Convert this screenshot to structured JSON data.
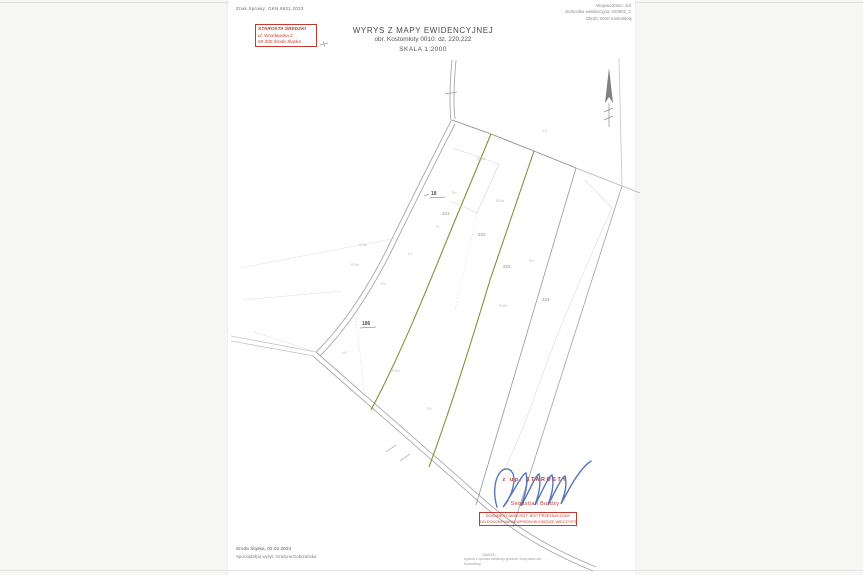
{
  "document": {
    "case_number": "Znak Sprawy: GKN.6621.2023",
    "region_lines": {
      "line1": "Województwo: dol.",
      "line2": "Jednostka ewidencyjna: 020902_2.",
      "line3": "Obręb: 0010 Kostomłoty"
    },
    "stamp": {
      "line1": "STAROSTA ŚREDZKI",
      "line2": "ul. Wrocławska 2",
      "line3": "55-300 Środa Śląska"
    },
    "title": {
      "line1": "WYRYS Z MAPY EWIDENCYJNEJ",
      "line2": "obr. Kostomłoty 0010: dz. 220,222",
      "line3": "SKALA 1:2000"
    }
  },
  "map": {
    "subject_parcels": "220,222",
    "scale": "1:2000",
    "parcel_labels": [
      {
        "text": "18"
      },
      {
        "text": "221"
      },
      {
        "text": "222"
      },
      {
        "text": "223"
      },
      {
        "text": "224"
      },
      {
        "text": "186"
      }
    ],
    "terrain_labels": [
      {
        "text": "RIVa"
      },
      {
        "text": "RV"
      },
      {
        "text": "RIVb"
      },
      {
        "text": "ŁV"
      },
      {
        "text": "RIVa"
      },
      {
        "text": "RIVb"
      },
      {
        "text": "RV"
      },
      {
        "text": "W"
      },
      {
        "text": "RV"
      },
      {
        "text": "RIVb"
      },
      {
        "text": "ŁIV"
      },
      {
        "text": "RIVa"
      },
      {
        "text": "RV"
      },
      {
        "text": "2.3"
      }
    ]
  },
  "signature": {
    "on_behalf": "z up. STAROSTY",
    "name": "Sebastian Burdzy"
  },
  "warning_box": {
    "line1": "DOKUMENT NINIEJSZY JEST PRZEZNACZONY",
    "line2": "DO DOKONYWANIA WPISÓW W KSIĘDZE WIECZYSTEJ"
  },
  "footer": {
    "place_date": "Środa Śląska, 02.02.2024",
    "prepared_by": "Sporządził(a) wyrys: Grażyna Dobrzańska",
    "fine_print_line1": "UWAGA:",
    "fine_print_line2": "wydruk z operatu ewidencji gruntów i budynków obr. Kostomłoty"
  },
  "colors": {
    "stamp_red": "#c4392f",
    "signature_blue": "#3b5ea9",
    "highlight_olive": "#8a8f34",
    "linework_gray": "#a8a8a8",
    "paper_white": "#ffffff",
    "background_gray": "#f6f6f5"
  }
}
